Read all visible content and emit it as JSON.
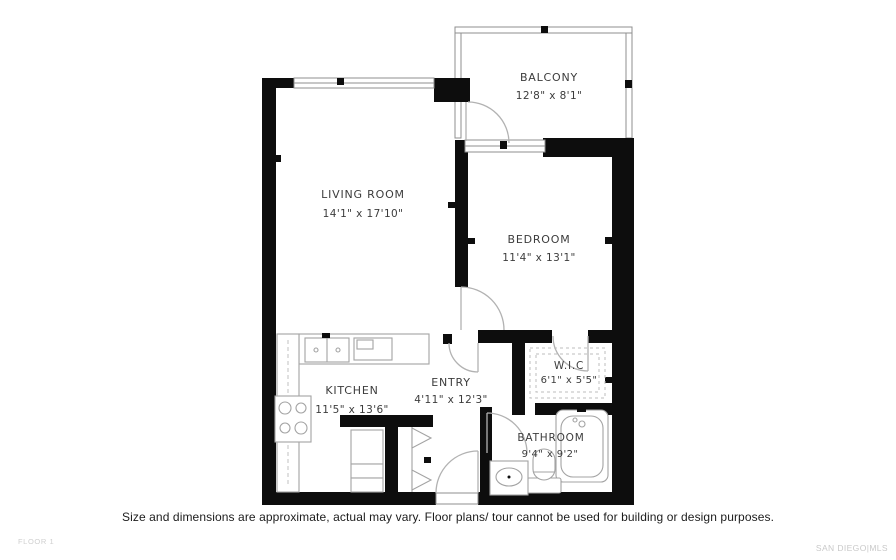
{
  "rooms": [
    {
      "id": "balcony",
      "name": "BALCONY",
      "dims": "12'8\" x 8'1\""
    },
    {
      "id": "living",
      "name": "LIVING ROOM",
      "dims": "14'1\" x 17'10\""
    },
    {
      "id": "bedroom",
      "name": "BEDROOM",
      "dims": "11'4\" x 13'1\""
    },
    {
      "id": "kitchen",
      "name": "KITCHEN",
      "dims": "11'5\" x 13'6\""
    },
    {
      "id": "entry",
      "name": "ENTRY",
      "dims": "4'11\" x 12'3\""
    },
    {
      "id": "wic",
      "name": "W.I.C",
      "dims": "6'1\" x 5'5\""
    },
    {
      "id": "bathroom",
      "name": "BATHROOM",
      "dims": "9'4\" x 9'2\""
    }
  ],
  "footer": {
    "disclaimer": "Size and dimensions are approximate, actual may vary. Floor plans/ tour cannot be used for building or design purposes.",
    "floor_label": "FLOOR 1",
    "brand": "SAN DIEGO|MLS"
  },
  "colors": {
    "wall": "#0d0d0d",
    "fixture_line": "#a3a3a3",
    "label_text": "#3c3c3c",
    "muted_text": "#c9c9c9"
  }
}
